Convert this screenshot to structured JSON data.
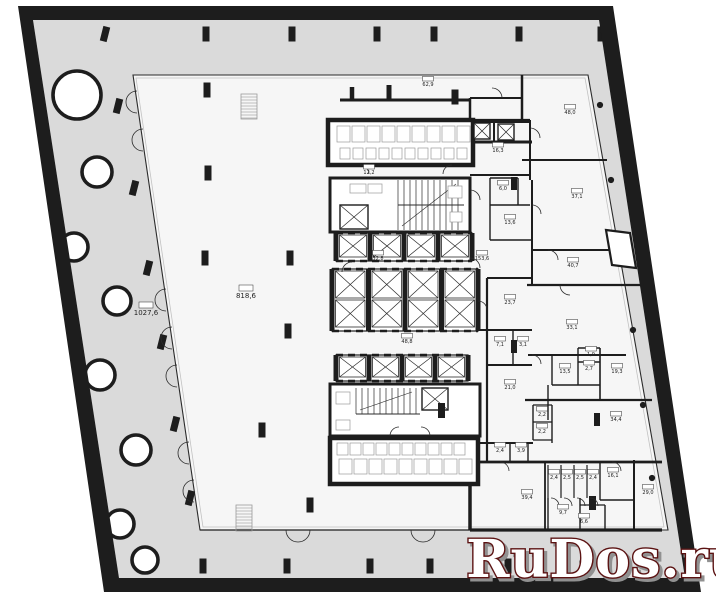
{
  "palette": {
    "wall": "#1d1d1d",
    "terrace": "#dadada",
    "floor": "#f6f6f6",
    "white": "#ffffff",
    "line": "#2b2b2b",
    "light": "#c2c2c2",
    "furniture": "#9a9a9a",
    "wm_fill": "#ffffff",
    "wm_outline": "#5b1212",
    "wm_shadow": "#919191"
  },
  "watermark": {
    "text": "RuDos.ru"
  },
  "outline": {
    "outer": [
      [
        18,
        6
      ],
      [
        613,
        6
      ],
      [
        701,
        592
      ],
      [
        104,
        592
      ]
    ],
    "inner": [
      [
        33,
        20
      ],
      [
        599,
        20
      ],
      [
        685,
        578
      ],
      [
        119,
        578
      ]
    ]
  },
  "plate": {
    "pts": [
      [
        133,
        75
      ],
      [
        588,
        75
      ],
      [
        668,
        530
      ],
      [
        200,
        530
      ]
    ],
    "inner": [
      [
        136,
        78
      ],
      [
        585,
        78
      ],
      [
        664,
        527
      ],
      [
        203,
        527
      ]
    ]
  },
  "round_columns": [
    [
      77,
      95,
      24
    ],
    [
      97,
      172,
      15
    ],
    [
      74,
      247,
      14
    ],
    [
      117,
      301,
      14
    ],
    [
      100,
      375,
      15
    ],
    [
      136,
      450,
      15
    ],
    [
      120,
      524,
      14
    ],
    [
      145,
      560,
      13
    ]
  ],
  "small_columns": {
    "top_y": 34,
    "top": [
      105,
      206,
      292,
      377,
      434,
      519,
      601
    ],
    "left": [
      [
        118,
        106
      ],
      [
        134,
        188
      ],
      [
        148,
        268
      ],
      [
        162,
        342
      ],
      [
        175,
        424
      ],
      [
        190,
        498
      ]
    ],
    "bottom": [
      [
        203,
        566
      ],
      [
        287,
        566
      ],
      [
        370,
        566
      ],
      [
        430,
        566
      ],
      [
        508,
        566
      ],
      [
        583,
        568
      ],
      [
        655,
        570
      ]
    ],
    "plate": [
      [
        207,
        90
      ],
      [
        208,
        173
      ],
      [
        205,
        258
      ],
      [
        290,
        258
      ],
      [
        288,
        331
      ],
      [
        262,
        430
      ],
      [
        310,
        505
      ],
      [
        455,
        97
      ]
    ]
  },
  "edge_dots": [
    [
      600,
      105
    ],
    [
      611,
      180
    ],
    [
      622,
      255
    ],
    [
      633,
      330
    ],
    [
      643,
      405
    ],
    [
      652,
      478
    ]
  ],
  "core": {
    "roomA": [
      328,
      120,
      145,
      45
    ],
    "roomG": [
      330,
      438,
      148,
      46
    ],
    "stairBlockA": [
      330,
      178,
      140,
      54
    ],
    "stairBlockB": [
      330,
      384,
      150,
      52
    ],
    "banks": [
      {
        "x": 336,
        "y": 233,
        "w": 136,
        "h": 28,
        "rows": 1
      },
      {
        "x": 332,
        "y": 269,
        "w": 146,
        "h": 62,
        "rows": 2
      },
      {
        "x": 336,
        "y": 355,
        "w": 132,
        "h": 26,
        "rows": 1
      }
    ],
    "lifts": [
      [
        340,
        205,
        28,
        24
      ],
      [
        422,
        388,
        26,
        22
      ],
      [
        474,
        123,
        16,
        16
      ],
      [
        498,
        124,
        16,
        16
      ]
    ],
    "stairs": [
      {
        "x": 398,
        "y": 180,
        "y2": 230,
        "n": 11,
        "dx": 6,
        "mid": 205,
        "x2": 464
      },
      {
        "x": 356,
        "y": 388,
        "y2": 414,
        "n": 11,
        "dx": 6,
        "mid": 414,
        "x2": 420
      }
    ],
    "ladders": [
      [
        241,
        94,
        16,
        25
      ],
      [
        236,
        505,
        16,
        26
      ]
    ]
  },
  "walls": [
    [
      340,
      100,
      470,
      100,
      3
    ],
    [
      352,
      87,
      352,
      100,
      4.5
    ],
    [
      389,
      85,
      389,
      100,
      5
    ],
    [
      470,
      98,
      522,
      98,
      2
    ],
    [
      522,
      75,
      522,
      120,
      2.5
    ],
    [
      470,
      98,
      470,
      142,
      2.5
    ],
    [
      530,
      120,
      530,
      180,
      2
    ],
    [
      522,
      160,
      607,
      160,
      2
    ],
    [
      473,
      120,
      530,
      120,
      2.2
    ],
    [
      470,
      142,
      532,
      142,
      3
    ],
    [
      470,
      175,
      530,
      175,
      2
    ],
    [
      490,
      178,
      518,
      178,
      1.4
    ],
    [
      490,
      178,
      490,
      240,
      1.4
    ],
    [
      518,
      178,
      518,
      205,
      1.4
    ],
    [
      490,
      205,
      530,
      205,
      1.4
    ],
    [
      490,
      240,
      532,
      240,
      1.6
    ],
    [
      532,
      180,
      532,
      285,
      2
    ],
    [
      532,
      250,
      631,
      250,
      2
    ],
    [
      527,
      285,
      641,
      285,
      2.2
    ],
    [
      487,
      278,
      487,
      462,
      2.2
    ],
    [
      487,
      278,
      532,
      278,
      2
    ],
    [
      470,
      330,
      532,
      330,
      2
    ],
    [
      513,
      330,
      513,
      365,
      1.4
    ],
    [
      487,
      365,
      532,
      365,
      2
    ],
    [
      528,
      355,
      626,
      355,
      2
    ],
    [
      578,
      348,
      578,
      385,
      1.4
    ],
    [
      578,
      362,
      600,
      362,
      1.4
    ],
    [
      600,
      348,
      600,
      400,
      1.6
    ],
    [
      578,
      348,
      600,
      348,
      1.4
    ],
    [
      552,
      385,
      600,
      385,
      1.6
    ],
    [
      552,
      355,
      552,
      385,
      1.4
    ],
    [
      525,
      400,
      652,
      400,
      2.2
    ],
    [
      548,
      385,
      548,
      420,
      1.4
    ],
    [
      533,
      405,
      552,
      405,
      1.2
    ],
    [
      533,
      405,
      533,
      440,
      1.4
    ],
    [
      552,
      405,
      552,
      443,
      1.4
    ],
    [
      533,
      422,
      552,
      422,
      1.2
    ],
    [
      533,
      440,
      552,
      440,
      1.2
    ],
    [
      470,
      443,
      533,
      443,
      2
    ],
    [
      510,
      443,
      510,
      462,
      1.4
    ],
    [
      528,
      443,
      528,
      462,
      1.4
    ],
    [
      470,
      462,
      662,
      462,
      2.8
    ],
    [
      548,
      465,
      548,
      498,
      1.2
    ],
    [
      561,
      465,
      561,
      498,
      1.2
    ],
    [
      574,
      465,
      574,
      498,
      1.2
    ],
    [
      587,
      465,
      587,
      498,
      1.2
    ],
    [
      600,
      462,
      600,
      500,
      1.4
    ],
    [
      600,
      500,
      634,
      500,
      1.4
    ],
    [
      634,
      460,
      634,
      530,
      2
    ],
    [
      545,
      462,
      545,
      530,
      1.8
    ],
    [
      580,
      498,
      580,
      530,
      1.4
    ],
    [
      605,
      505,
      605,
      530,
      1.4
    ],
    [
      580,
      505,
      605,
      505,
      1.2
    ],
    [
      548,
      498,
      548,
      530,
      1.4
    ],
    [
      470,
      440,
      470,
      530,
      3.5
    ],
    [
      470,
      122,
      530,
      122,
      2
    ],
    [
      494,
      122,
      494,
      142,
      2
    ],
    [
      470,
      530,
      662,
      530,
      3.2
    ],
    [
      200,
      530,
      470,
      530,
      1.2
    ]
  ],
  "black_bars": [
    [
      511,
      177,
      6,
      13
    ],
    [
      511,
      340,
      6,
      13
    ],
    [
      594,
      413,
      6,
      13
    ],
    [
      589,
      496,
      7,
      14
    ],
    [
      438,
      403,
      7,
      15
    ]
  ],
  "furniture_rows": [
    {
      "x": 337,
      "y": 126,
      "w": 13,
      "h": 16,
      "n": 9,
      "dx": 15
    },
    {
      "x": 340,
      "y": 148,
      "w": 10,
      "h": 11,
      "n": 10,
      "dx": 13
    },
    {
      "x": 337,
      "y": 443,
      "w": 11,
      "h": 12,
      "n": 10,
      "dx": 13
    },
    {
      "x": 339,
      "y": 459,
      "w": 13,
      "h": 15,
      "n": 9,
      "dx": 15
    }
  ],
  "furniture_single": [
    [
      350,
      184,
      16,
      9
    ],
    [
      368,
      184,
      14,
      9
    ],
    [
      336,
      392,
      14,
      12
    ],
    [
      336,
      420,
      14,
      10
    ],
    [
      448,
      186,
      14,
      12
    ],
    [
      450,
      212,
      12,
      10
    ]
  ],
  "slant_box": [
    [
      606,
      230
    ],
    [
      630,
      233
    ],
    [
      636,
      268
    ],
    [
      612,
      265
    ]
  ],
  "left_doors": {
    "ys": [
      102,
      140,
      300,
      338,
      376,
      453,
      491
    ],
    "r": 11,
    "x0": 133,
    "k": 0.1476,
    "y0": 75
  },
  "bottom_doors": {
    "xs": [
      298,
      423
    ],
    "r": 12,
    "y": 530
  },
  "door_arcs": [
    "M502 98 A10 10 0 0 0 492 88",
    "M530 128 A10 10 0 0 1 540 138",
    "M548 250 A10 10 0 0 1 558 260",
    "M560 285 A10 10 0 0 0 570 295",
    "M532 355 A9 9 0 0 1 541 364",
    "M500 462 A9 9 0 0 1 509 471",
    "M612 462 A9 9 0 0 1 621 471",
    "M551 498 A8 8 0 0 1 559 506",
    "M564 498 A8 8 0 0 1 572 506",
    "M577 498 A8 8 0 0 1 585 506",
    "M590 498 A8 8 0 0 1 598 506",
    "M470 258 A10 10 0 0 1 480 268",
    "M352 262 A10 10 0 0 0 342 272",
    "M360 165 A9 9 0 0 1 369 174",
    "M452 165 A9 9 0 0 0 443 174",
    "M532 205 A9 9 0 0 1 541 214",
    "M487 310 A9 9 0 0 0 478 301",
    "M430 436 A9 9 0 0 0 421 427",
    "M390 436 A9 9 0 0 1 399 427",
    "M470 190 A10 10 0 0 1 480 200"
  ],
  "rooms": [
    {
      "a": "62,9",
      "x": 428,
      "y": 86
    },
    {
      "a": "48,0",
      "x": 570,
      "y": 114
    },
    {
      "a": "16,3",
      "x": 498,
      "y": 152
    },
    {
      "a": "6,0",
      "x": 503,
      "y": 190
    },
    {
      "a": "13,6",
      "x": 510,
      "y": 224
    },
    {
      "a": "37,1",
      "x": 577,
      "y": 198
    },
    {
      "a": "40,7",
      "x": 573,
      "y": 267
    },
    {
      "a": "153,6",
      "x": 482,
      "y": 260
    },
    {
      "a": "32,8",
      "x": 378,
      "y": 260
    },
    {
      "a": "12,2",
      "x": 369,
      "y": 174
    },
    {
      "a": "23,7",
      "x": 510,
      "y": 304
    },
    {
      "a": "33,1",
      "x": 572,
      "y": 329
    },
    {
      "a": "7,1",
      "x": 500,
      "y": 346
    },
    {
      "a": "3,1",
      "x": 523,
      "y": 346
    },
    {
      "a": "1,9",
      "x": 591,
      "y": 356
    },
    {
      "a": "2,7",
      "x": 589,
      "y": 370
    },
    {
      "a": "13,5",
      "x": 565,
      "y": 373
    },
    {
      "a": "19,3",
      "x": 617,
      "y": 373
    },
    {
      "a": "21,0",
      "x": 510,
      "y": 389
    },
    {
      "a": "48,8",
      "x": 407,
      "y": 343
    },
    {
      "a": "2,2",
      "x": 542,
      "y": 416
    },
    {
      "a": "2,2",
      "x": 542,
      "y": 433
    },
    {
      "a": "2,4",
      "x": 500,
      "y": 452
    },
    {
      "a": "3,9",
      "x": 521,
      "y": 452
    },
    {
      "a": "34,4",
      "x": 616,
      "y": 421
    },
    {
      "a": "2,4",
      "x": 554,
      "y": 479
    },
    {
      "a": "2,5",
      "x": 567,
      "y": 479
    },
    {
      "a": "2,5",
      "x": 580,
      "y": 479
    },
    {
      "a": "2,4",
      "x": 593,
      "y": 479
    },
    {
      "a": "16,1",
      "x": 613,
      "y": 477
    },
    {
      "a": "29,0",
      "x": 648,
      "y": 494
    },
    {
      "a": "39,4",
      "x": 527,
      "y": 499
    },
    {
      "a": "9,7",
      "x": 563,
      "y": 514
    },
    {
      "a": "6,6",
      "x": 584,
      "y": 523
    }
  ],
  "big_rooms": [
    {
      "a": "818,6",
      "x": 246,
      "y": 298
    },
    {
      "a": "1027,6",
      "x": 146,
      "y": 315
    }
  ]
}
